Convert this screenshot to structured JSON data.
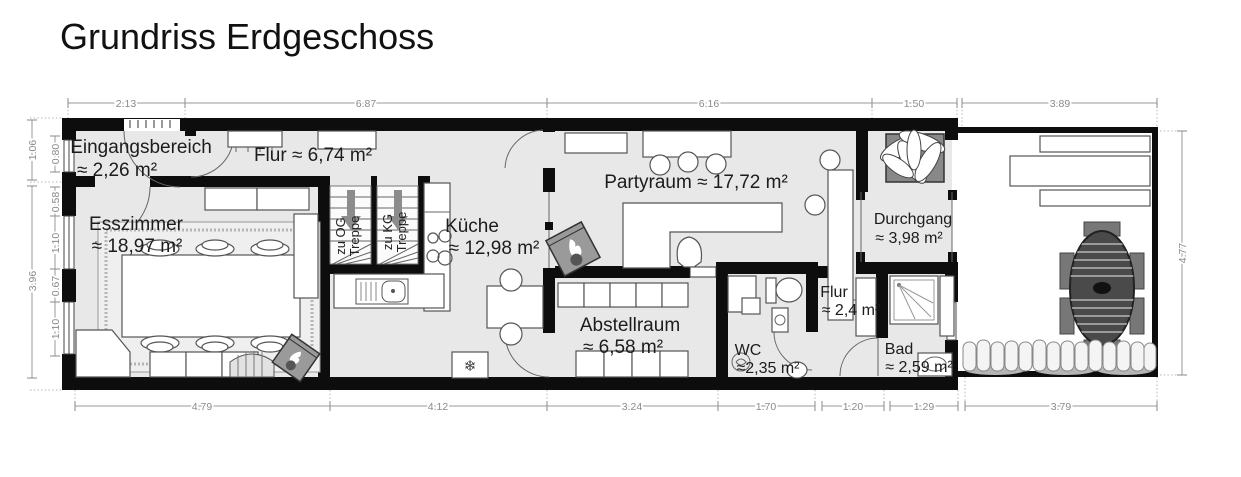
{
  "title": "Grundriss Erdgeschoss",
  "rooms": [
    {
      "name": "Eingangsbereich",
      "area": "≈ 2,26 m²"
    },
    {
      "label": "Flur ≈ 6,74 m²"
    },
    {
      "name": "Esszimmer",
      "area": "≈ 18,97 m²"
    },
    {
      "name": "Küche",
      "area": "≈ 12,98 m²"
    },
    {
      "label": "Partyraum ≈ 17,72 m²"
    },
    {
      "name": "Durchgang",
      "area": "≈ 3,98 m²"
    },
    {
      "name": "Abstellraum",
      "area": "≈ 6,58 m²"
    },
    {
      "name": "WC",
      "area": "≈2,35 m²"
    },
    {
      "name": "Flur",
      "area": "≈ 2,4 m²"
    },
    {
      "name": "Bad",
      "area": "≈ 2,59 m²"
    }
  ],
  "stairs": [
    {
      "lines": [
        "Treppe",
        "zu OG"
      ]
    },
    {
      "lines": [
        "Treppe",
        "zu KG"
      ]
    }
  ],
  "dimensions": {
    "top": [
      "2.13",
      "6.87",
      "6.16",
      "1.50",
      "3.89"
    ],
    "bottom": [
      "4.79",
      "4.12",
      "3.24",
      "1.70",
      "1.20",
      "1.29",
      "3.79"
    ],
    "left_outer": [
      "1.06",
      "3.96"
    ],
    "left_inner": [
      "0.80",
      "0.58",
      "1.10",
      "0.67",
      "1.10"
    ],
    "right": [
      "4.77"
    ]
  },
  "icons": {
    "snowflake": "❄"
  },
  "colors": {
    "wall": "#0d0d0d",
    "floor": "#e8e8e8",
    "dim_gray": "#8a8a8a",
    "stove_gray": "#9a9a9a"
  }
}
